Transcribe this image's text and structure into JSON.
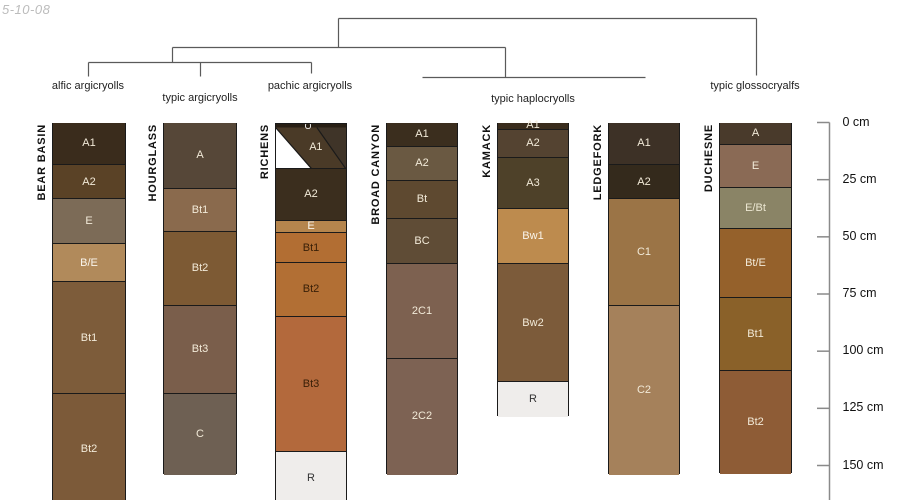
{
  "figure": {
    "date_label": "5-10-08",
    "background": "#ffffff"
  },
  "style": {
    "band_border_color": "#1a1a1a",
    "dendrogram_color": "#5a5a5a",
    "axis_color": "#8a8a8a",
    "date_color": "#bcbcbc",
    "default_band_label_color": "#f2ead8"
  },
  "chart_data": {
    "type": "other",
    "subtype": "soil-pedon-horizon-columns-with-classification-dendrogram",
    "depth_axis": {
      "unit": "cm",
      "axis_x_px": 829.5,
      "y0_px": 122.5,
      "px_per_cm": 2.2867,
      "tick_values": [
        0,
        25,
        50,
        75,
        100,
        125,
        150
      ],
      "tick_labels": [
        "0 cm",
        "25 cm",
        "50 cm",
        "75 cm",
        "100 cm",
        "125 cm",
        "150 cm"
      ]
    },
    "classification_labels": [
      {
        "text": "alfic argicryolls",
        "x": 88,
        "label_top": 80
      },
      {
        "text": "typic argicryolls",
        "x": 200,
        "label_top": 92
      },
      {
        "text": "pachic argicryolls",
        "x": 310,
        "label_top": 80
      },
      {
        "text": "typic haplocryolls",
        "x": 533,
        "label_top": 93
      },
      {
        "text": "typic glossocryalfs",
        "x": 755,
        "label_top": 80
      }
    ],
    "dendrogram": {
      "segments": [
        {
          "x1": 338,
          "y1": 18,
          "x2": 756,
          "y2": 18
        },
        {
          "x1": 338,
          "y1": 18,
          "x2": 338,
          "y2": 47
        },
        {
          "x1": 756,
          "y1": 18,
          "x2": 756,
          "y2": 75
        },
        {
          "x1": 172,
          "y1": 47,
          "x2": 505,
          "y2": 47
        },
        {
          "x1": 172,
          "y1": 47,
          "x2": 172,
          "y2": 62
        },
        {
          "x1": 505,
          "y1": 47,
          "x2": 505,
          "y2": 77
        },
        {
          "x1": 88,
          "y1": 62,
          "x2": 311,
          "y2": 62
        },
        {
          "x1": 88,
          "y1": 62,
          "x2": 88,
          "y2": 76
        },
        {
          "x1": 200,
          "y1": 62,
          "x2": 200,
          "y2": 76
        },
        {
          "x1": 311,
          "y1": 62,
          "x2": 311,
          "y2": 73
        },
        {
          "x1": 422,
          "y1": 77,
          "x2": 645,
          "y2": 77
        }
      ]
    },
    "pedons": [
      {
        "name": "BEAR BASIN",
        "classification": "alfic argicryolls",
        "x_left": 52,
        "width": 74,
        "cut_off_bottom": true,
        "horizons": [
          {
            "name": "A1",
            "top_cm": 0,
            "bottom_cm": 18.1,
            "color": "#3a2c1c"
          },
          {
            "name": "A2",
            "top_cm": 18.1,
            "bottom_cm": 33.1,
            "color": "#5a4226"
          },
          {
            "name": "E",
            "top_cm": 33.1,
            "bottom_cm": 52.9,
            "color": "#7c6b57"
          },
          {
            "name": "B/E",
            "top_cm": 52.9,
            "bottom_cm": 69.4,
            "color": "#b18a5b",
            "label_color": "#faf5ec"
          },
          {
            "name": "Bt1",
            "top_cm": 69.4,
            "bottom_cm": 118.3,
            "color": "#7d5c3a"
          },
          {
            "name": "Bt2",
            "top_cm": 118.3,
            "bottom_cm": 167,
            "color": "#7c5a39"
          }
        ]
      },
      {
        "name": "HOURGLASS",
        "classification": "typic argicryolls",
        "x_left": 163,
        "width": 74,
        "cut_off_bottom": false,
        "horizons": [
          {
            "name": "A",
            "top_cm": 0,
            "bottom_cm": 28.6,
            "color": "#564738"
          },
          {
            "name": "Bt1",
            "top_cm": 28.6,
            "bottom_cm": 47.4,
            "color": "#8a6a4d"
          },
          {
            "name": "Bt2",
            "top_cm": 47.4,
            "bottom_cm": 79.8,
            "color": "#7d5a34"
          },
          {
            "name": "Bt3",
            "top_cm": 79.8,
            "bottom_cm": 118.3,
            "color": "#7a5e4b"
          },
          {
            "name": "C",
            "top_cm": 118.3,
            "bottom_cm": 153.7,
            "color": "#6e6053"
          }
        ]
      },
      {
        "name": "RICHENS",
        "classification": "pachic argicryolls",
        "x_left": 275,
        "width": 72,
        "cut_off_bottom": true,
        "top_zone": {
          "bottom_cm": 19.9,
          "o_label": "O",
          "o_color": "#281f14",
          "o_label_color": "#ffffff",
          "a1_label": "A1",
          "a1_color": "#4a3a27",
          "a1_label_color": "#f2ead8",
          "corner_color": "#3f3428",
          "gap_color": "#ffffff"
        },
        "horizons": [
          {
            "name": "A2",
            "top_cm": 19.9,
            "bottom_cm": 42.6,
            "color": "#3b2e1e"
          },
          {
            "name": "E",
            "top_cm": 42.6,
            "bottom_cm": 47.9,
            "color": "#b5854d",
            "label_color": "#faf5ec"
          },
          {
            "name": "Bt1",
            "top_cm": 47.9,
            "bottom_cm": 61.0,
            "color": "#b26e33",
            "label_color": "#3a2008"
          },
          {
            "name": "Bt2",
            "top_cm": 61.0,
            "bottom_cm": 84.6,
            "color": "#b26f34",
            "label_color": "#3a2008"
          },
          {
            "name": "Bt3",
            "top_cm": 84.6,
            "bottom_cm": 143.7,
            "color": "#b3693c",
            "label_color": "#3a2008"
          },
          {
            "name": "R",
            "top_cm": 143.7,
            "bottom_cm": 167,
            "color": "#efedeb",
            "label_color": "#333333"
          }
        ]
      },
      {
        "name": "BROAD CANYON",
        "classification": "typic haplocryolls",
        "x_left": 386,
        "width": 72,
        "cut_off_bottom": false,
        "horizons": [
          {
            "name": "A1",
            "top_cm": 0,
            "bottom_cm": 10.3,
            "color": "#3b2e1e"
          },
          {
            "name": "A2",
            "top_cm": 10.3,
            "bottom_cm": 25.1,
            "color": "#6a5942"
          },
          {
            "name": "Bt",
            "top_cm": 25.1,
            "bottom_cm": 41.8,
            "color": "#5e4930"
          },
          {
            "name": "BC",
            "top_cm": 41.8,
            "bottom_cm": 61.4,
            "color": "#5f4c36"
          },
          {
            "name": "2C1",
            "top_cm": 61.4,
            "bottom_cm": 103.0,
            "color": "#7d6150"
          },
          {
            "name": "2C2",
            "top_cm": 103.0,
            "bottom_cm": 153.7,
            "color": "#7d6253"
          }
        ]
      },
      {
        "name": "KAMACK",
        "classification": "typic haplocryolls",
        "x_left": 497,
        "width": 72,
        "cut_off_bottom": false,
        "horizons": [
          {
            "name": "A1",
            "top_cm": 0,
            "bottom_cm": 2.8,
            "color": "#392c1c"
          },
          {
            "name": "A2",
            "top_cm": 2.8,
            "bottom_cm": 15.1,
            "color": "#544331"
          },
          {
            "name": "A3",
            "top_cm": 15.1,
            "bottom_cm": 37.4,
            "color": "#4e4129"
          },
          {
            "name": "Bw1",
            "top_cm": 37.4,
            "bottom_cm": 61.4,
            "color": "#bd8b4e",
            "label_color": "#faf5ec"
          },
          {
            "name": "Bw2",
            "top_cm": 61.4,
            "bottom_cm": 113.1,
            "color": "#7c5b3a"
          },
          {
            "name": "R",
            "top_cm": 113.1,
            "bottom_cm": 128.4,
            "color": "#efedeb",
            "label_color": "#333333"
          }
        ]
      },
      {
        "name": "LEDGEFORK",
        "classification": "typic haplocryolls",
        "x_left": 608,
        "width": 72,
        "cut_off_bottom": false,
        "horizons": [
          {
            "name": "A1",
            "top_cm": 0,
            "bottom_cm": 18.1,
            "color": "#3d3126"
          },
          {
            "name": "A2",
            "top_cm": 18.1,
            "bottom_cm": 33.1,
            "color": "#342a1c"
          },
          {
            "name": "C1",
            "top_cm": 33.1,
            "bottom_cm": 79.8,
            "color": "#9b7446"
          },
          {
            "name": "C2",
            "top_cm": 79.8,
            "bottom_cm": 153.7,
            "color": "#a5815b"
          }
        ]
      },
      {
        "name": "DUCHESNE",
        "classification": "typic glossocryalfs",
        "x_left": 719,
        "width": 73,
        "cut_off_bottom": false,
        "horizons": [
          {
            "name": "A",
            "top_cm": 0,
            "bottom_cm": 9.6,
            "color": "#493a2b"
          },
          {
            "name": "E",
            "top_cm": 9.6,
            "bottom_cm": 28.2,
            "color": "#8a6a55"
          },
          {
            "name": "E/Bt",
            "top_cm": 28.2,
            "bottom_cm": 46.1,
            "color": "#8a8466",
            "label_color": "#ece7d2"
          },
          {
            "name": "Bt/E",
            "top_cm": 46.1,
            "bottom_cm": 76.3,
            "color": "#95612b"
          },
          {
            "name": "Bt1",
            "top_cm": 76.3,
            "bottom_cm": 108.2,
            "color": "#8a6129"
          },
          {
            "name": "Bt2",
            "top_cm": 108.2,
            "bottom_cm": 153.4,
            "color": "#8e5c36"
          }
        ]
      }
    ]
  }
}
